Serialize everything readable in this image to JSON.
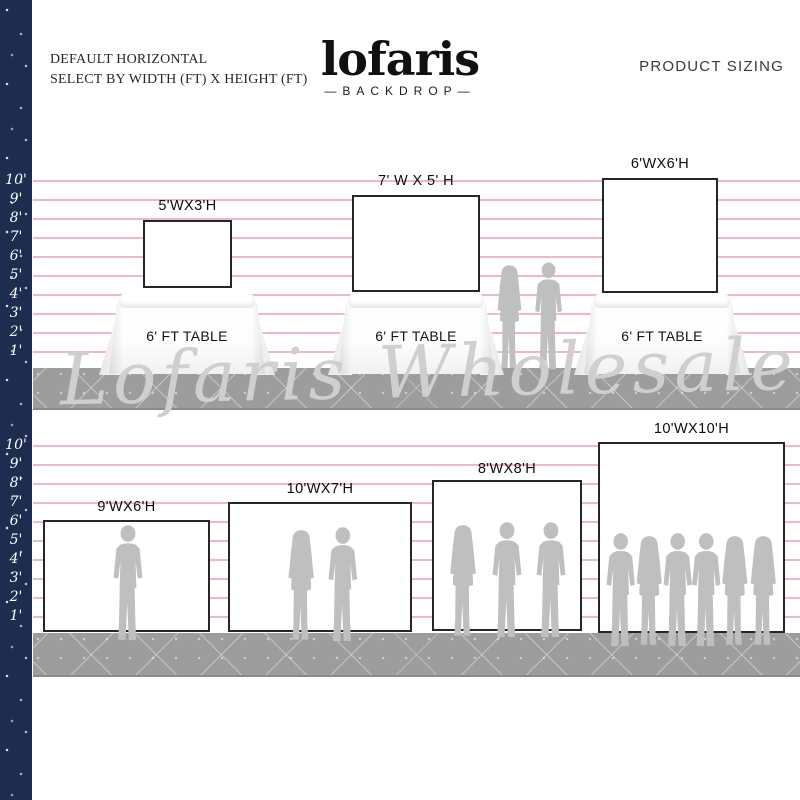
{
  "header": {
    "title_line1": "DEFAULT HORIZONTAL",
    "title_line2": "SELECT BY WIDTH (FT) X HEIGHT (FT)",
    "brand": "lofaris",
    "brand_sub": "—BACKDROP—",
    "product_sizing": "PRODUCT SIZING"
  },
  "watermark": "Lofaris Wholesale",
  "ruler_top": [
    "10'",
    "9'",
    "8'",
    "7'",
    "6'",
    "5'",
    "4'",
    "3'",
    "2'",
    "1'"
  ],
  "ruler_bottom": [
    "10'",
    "9'",
    "8'",
    "7'",
    "6'",
    "5'",
    "4'",
    "3'",
    "2'",
    "1'"
  ],
  "sizes_top": [
    {
      "label": "5'WX3'H",
      "table_label": "6' FT TABLE"
    },
    {
      "label": "7' W X 5' H",
      "table_label": "6' FT TABLE"
    },
    {
      "label": "6'WX6'H",
      "table_label": "6' FT TABLE"
    }
  ],
  "sizes_bottom": [
    {
      "label": "9'WX6'H",
      "people": 1
    },
    {
      "label": "10'WX7'H",
      "people": 2
    },
    {
      "label": "8'WX8'H",
      "people": 3
    },
    {
      "label": "10'WX10'H",
      "people": 6
    }
  ],
  "colors": {
    "navy": "#1e2c4f",
    "line_pink": "#efa6b0",
    "floor": "#9d9d9d",
    "silhouette": "#bfbfbf",
    "border": "#262626",
    "watermark": "#cfcfcf"
  }
}
